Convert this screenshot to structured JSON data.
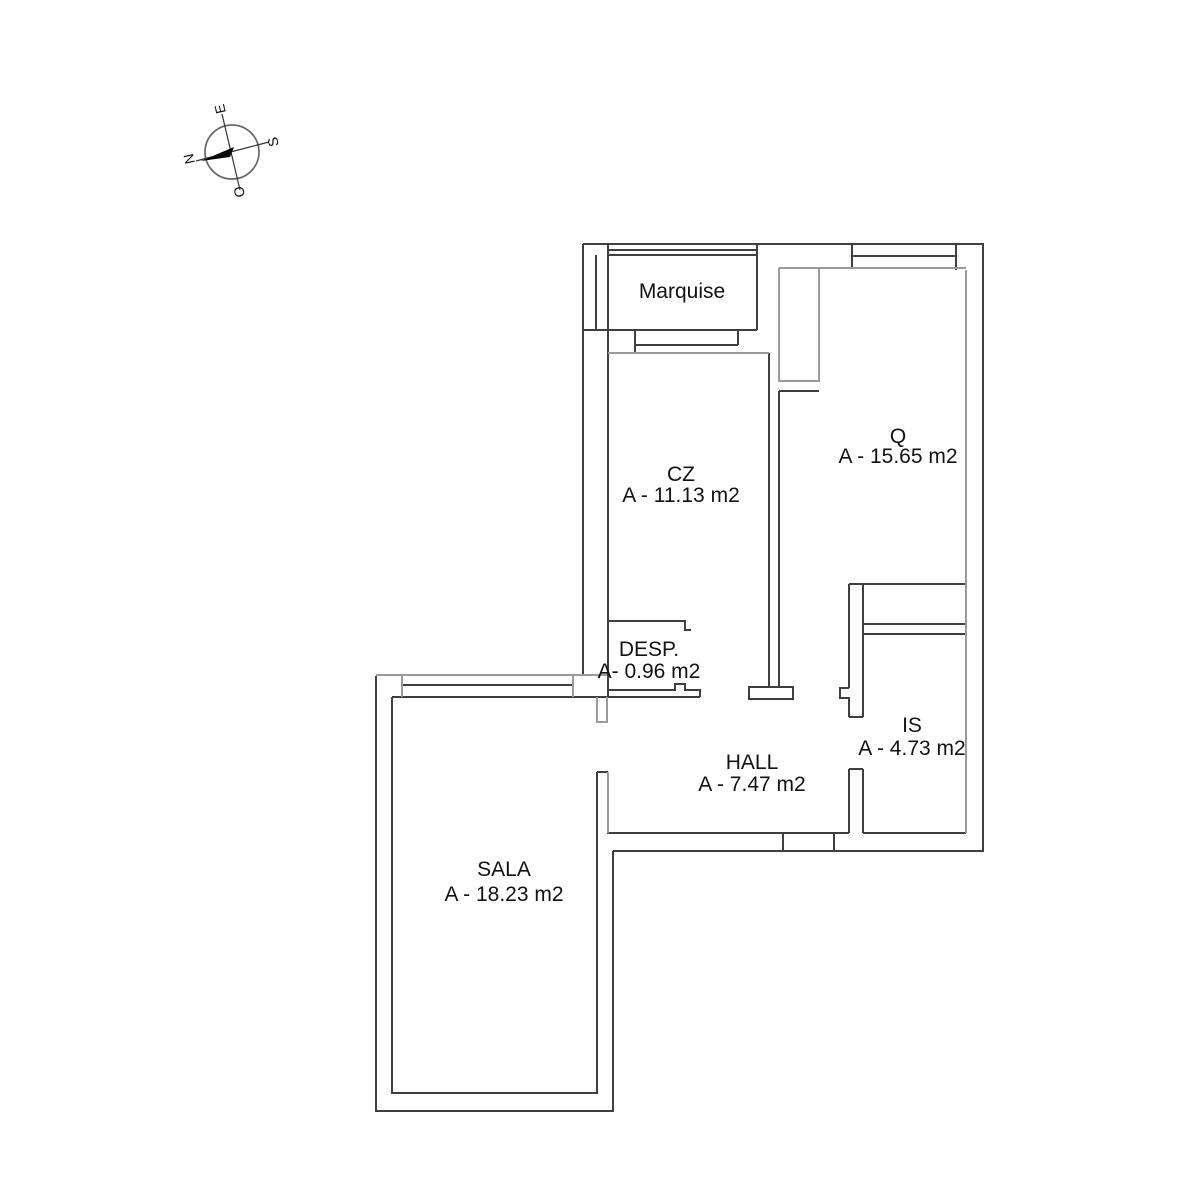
{
  "drawing": {
    "type": "apartment floor plan"
  },
  "compass": {
    "north": "N",
    "south": "S",
    "east": "E",
    "west": "O"
  },
  "rooms": {
    "marquise": {
      "name": "Marquise"
    },
    "cz": {
      "name": "CZ",
      "area": "A - 11.13 m2"
    },
    "q": {
      "name": "Q",
      "area": "A - 15.65 m2"
    },
    "desp": {
      "name": "DESP.",
      "area": "A- 0.96 m2"
    },
    "hall": {
      "name": "HALL",
      "area": "A - 7.47 m2"
    },
    "is": {
      "name": "IS",
      "area": "A - 4.73 m2"
    },
    "sala": {
      "name": "SALA",
      "area": "A - 18.23 m2"
    }
  },
  "colors": {
    "background": "#ffffff",
    "wall_dark": "#3f3f3f",
    "wall_gray": "#9a9a9a",
    "text": "#121212"
  }
}
